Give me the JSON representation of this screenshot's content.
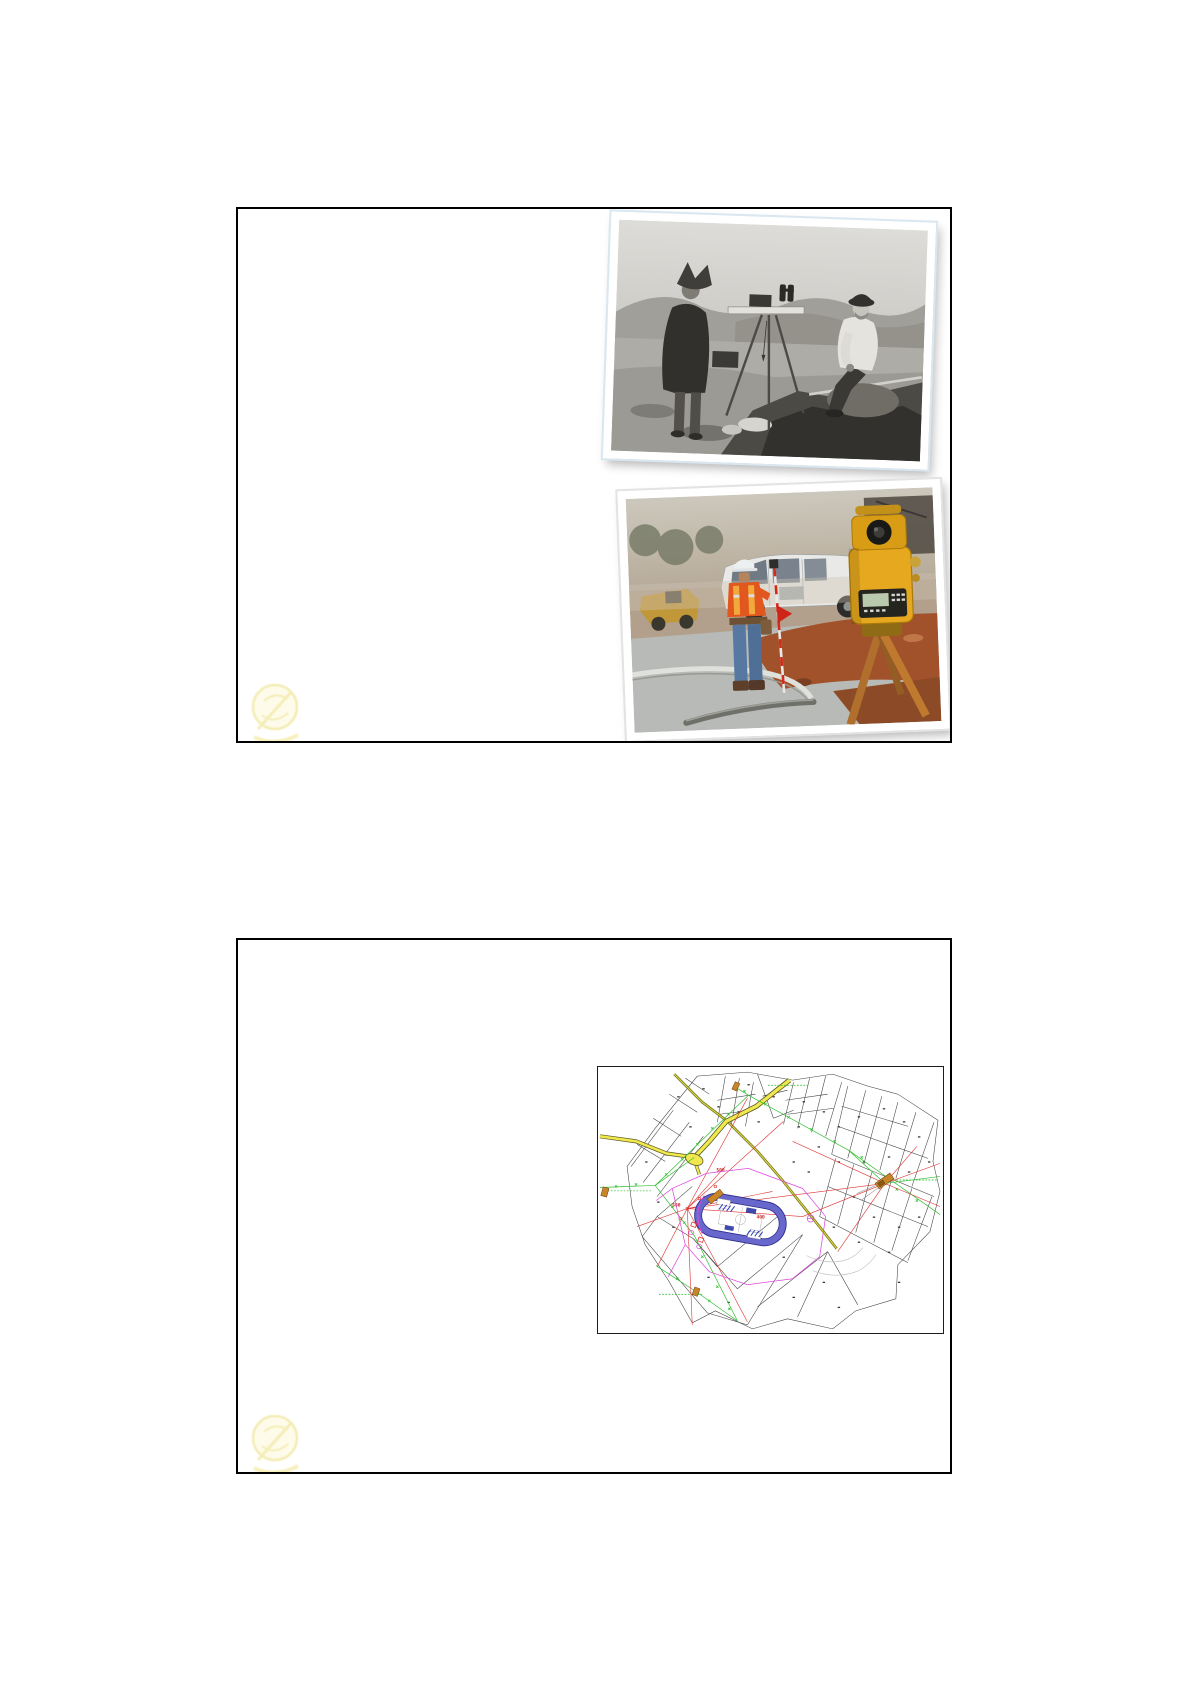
{
  "page": {
    "kind": "presentation handout page with two slides",
    "background": "#ffffff"
  },
  "slide1": {
    "photo_bw": {
      "alt": "Black-and-white photograph: two early surveyors in mountainous terrain, one standing in a poncho and pointed hat beside a plane table on a wooden tripod, one seated man in a bowler hat and white shirt, with a long survey rod on the rocks"
    },
    "photo_color": {
      "alt": "Color photograph: construction surveyor in white hard hat and orange hi-vis shirt holding a red flagged range pole near a white crew-cab pickup truck, with a yellow total station on an orange wooden tripod in the foreground"
    },
    "watermark": {
      "color": "#e6d75e"
    }
  },
  "slide2": {
    "map": {
      "alt": "Cadastral survey plan: numbered land parcels, yellow roads meeting at a junction, green dashed traverse lines with station marks, red survey rays radiating from two stations, brown benchmark symbols, and a running-track stadium outlined in blue-purple with a magenta boundary",
      "station_labels": [
        "500",
        "500",
        "400"
      ],
      "palette": {
        "parcel_line": "#3f3f3f",
        "road_yellow": "#f0e84e",
        "road_olive": "#6f6f1d",
        "traverse_green": "#2fbf2f",
        "survey_red": "#e03232",
        "stadium_blue": "#2e2e8f",
        "boundary_magenta": "#de4ade",
        "building_brown": "#c8862a"
      }
    },
    "watermark": {
      "color": "#e6d75e"
    }
  }
}
